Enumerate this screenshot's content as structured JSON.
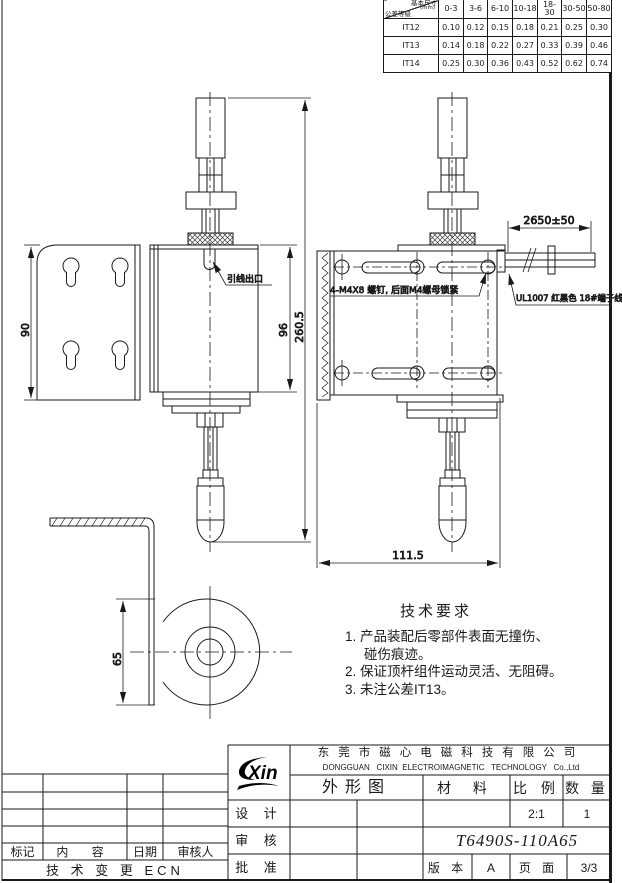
{
  "tolerance_table": {
    "corner": {
      "top": "基本尺寸",
      "unit": "(mm)",
      "bottom": "公差等级"
    },
    "columns": [
      "0-3",
      "3-6",
      "6-10",
      "10-18",
      "18-30",
      "30-50",
      "50-80"
    ],
    "rows": [
      {
        "grade": "IT12",
        "values": [
          "0.10",
          "0.12",
          "0.15",
          "0.18",
          "0.21",
          "0.25",
          "0.30"
        ]
      },
      {
        "grade": "IT13",
        "values": [
          "0.14",
          "0.18",
          "0.22",
          "0.27",
          "0.33",
          "0.39",
          "0.46"
        ]
      },
      {
        "grade": "IT14",
        "values": [
          "0.25",
          "0.30",
          "0.36",
          "0.43",
          "0.52",
          "0.62",
          "0.74"
        ]
      }
    ]
  },
  "dimensions": {
    "bracket_height": "90",
    "body_height": "96",
    "overall_height": "260.5",
    "wire_length": "2650±50",
    "body_width": "111.5",
    "foot_height": "65"
  },
  "callouts": {
    "wire_exit": "引线出口",
    "screws": "4-M4X8 螺钉, 后面M4螺母锁紧",
    "wire_spec": "UL1007 红黑色 18#端子线"
  },
  "tech_requirements": {
    "title": "技术要求",
    "lines": [
      "1. 产品装配后零部件表面无撞伤、",
      "碰伤痕迹。",
      "2. 保证顶杆组件运动灵活、无阻碍。",
      "3. 未注公差IT13。"
    ]
  },
  "title_block": {
    "logo_text": "Xin",
    "company_cn": "东莞市磁心电磁科技有限公司",
    "company_en": "DONGGUAN   CIXIN  ELECTROIMAGNETIC   TECHNOLOGY   Co.,Ltd",
    "drawing_type": "外形图",
    "material_label": "材 料",
    "scale_label": "比 例",
    "qty_label": "数 量",
    "scale_value": "2:1",
    "qty_value": "1",
    "design_label": "设 计",
    "review_label": "审 核",
    "approve_label": "批 准",
    "part_number": "T6490S-110A65",
    "version_label": "版 本",
    "version_value": "A",
    "page_label": "页 面",
    "page_value": "3/3"
  },
  "revision_table": {
    "headers": [
      "标记",
      "内 容",
      "日期",
      "审核人"
    ],
    "ecn_label": "技 术 变 更 ECN"
  }
}
